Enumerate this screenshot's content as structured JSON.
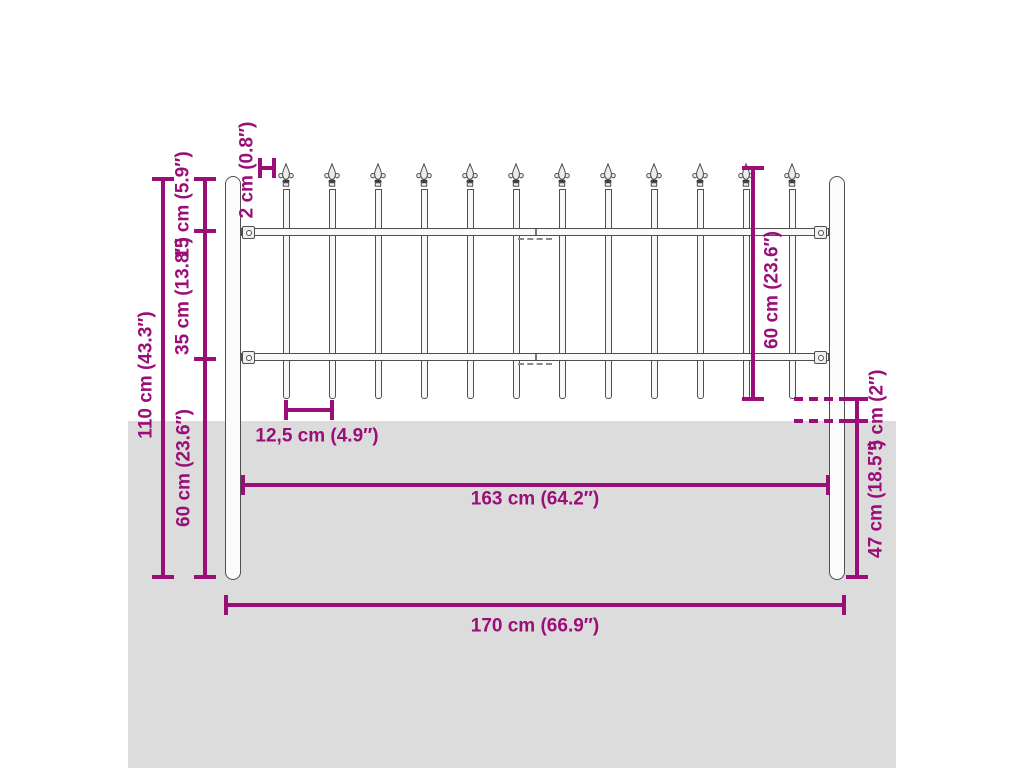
{
  "diagram": {
    "title": "Fence with spear top - dimension diagram",
    "type": "product-dimension-drawing",
    "colors": {
      "dimension": "#9b0e78",
      "ground": "#dcdcdc",
      "steel_outline": "#4f4f4f",
      "background": "#ffffff"
    },
    "fence": {
      "picket_count": 12,
      "post_count": 2,
      "rail_count": 2
    },
    "labels": {
      "height_total": "110 cm (43.3″)",
      "top_to_rail": "15 cm (5.9″)",
      "rail_to_rail": "35 cm (13.8″)",
      "post_below_rail": "60 cm (23.6″)",
      "spear_width": "2 cm (0.8″)",
      "panel_height": "60 cm (23.6″)",
      "ground_clearance": "5 cm (2″)",
      "post_depth": "47 cm (18.5″)",
      "picket_spacing": "12,5 cm (4.9″)",
      "inner_width": "163 cm (64.2″)",
      "total_width": "170 cm (66.9″)"
    }
  }
}
